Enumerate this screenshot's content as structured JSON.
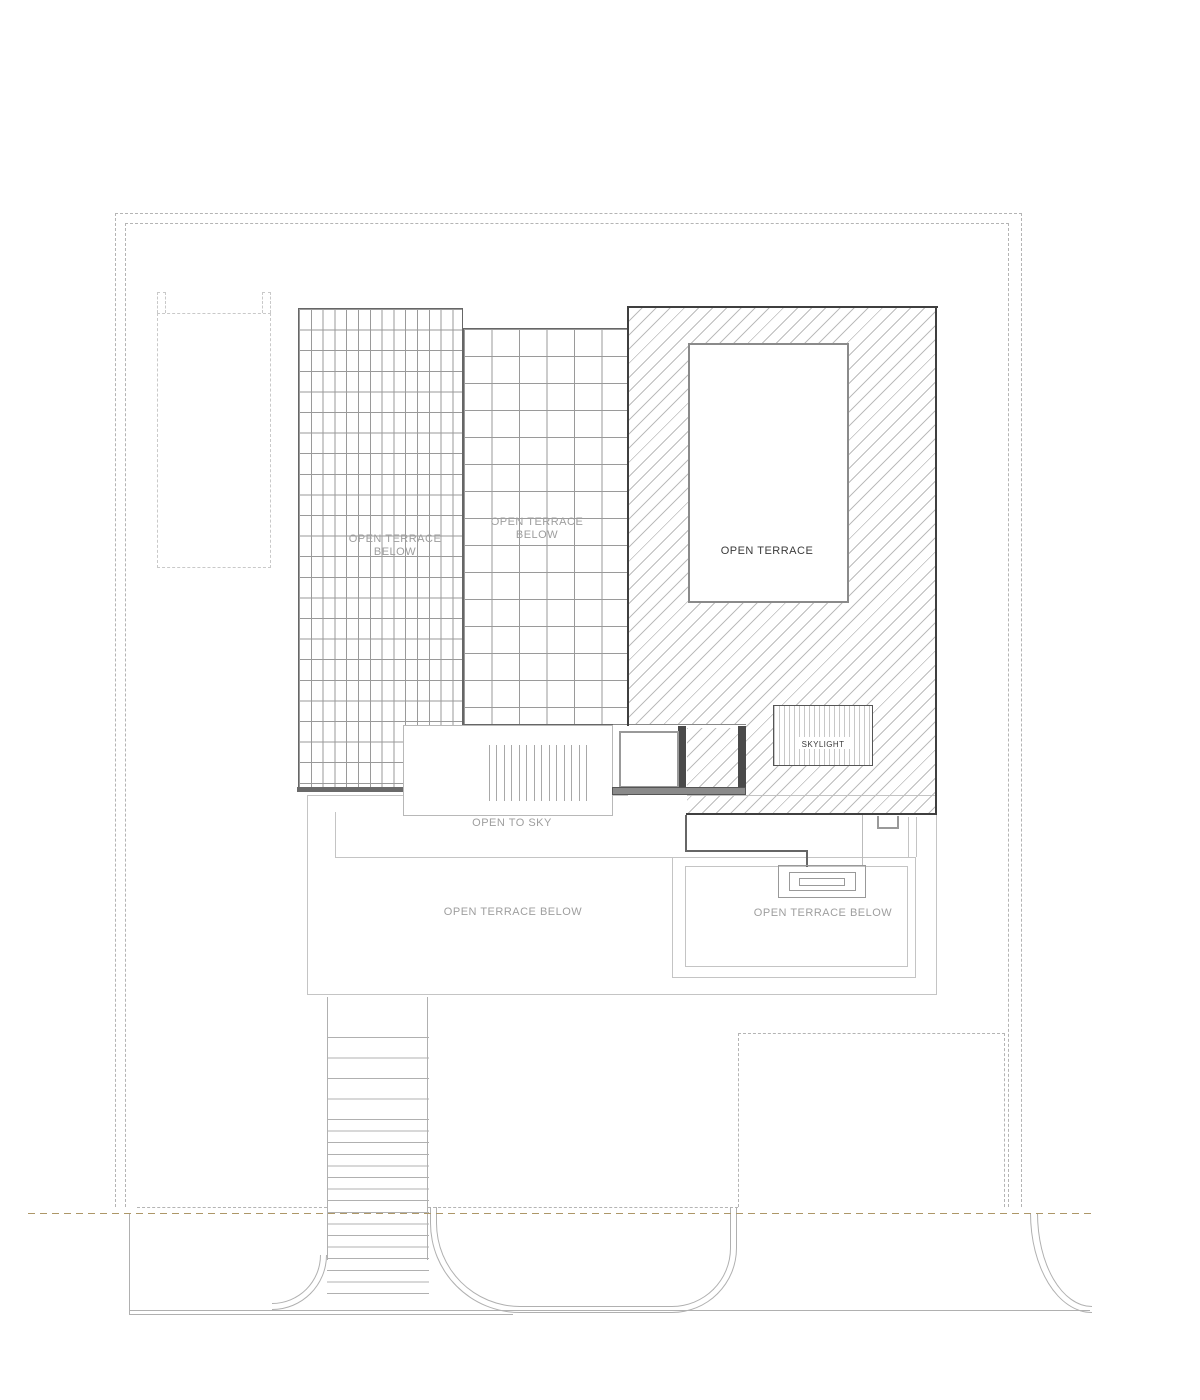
{
  "drawing": {
    "title": "roof-terrace-plan",
    "labels": {
      "terrace_left": "OPEN TERRACE\nBELOW",
      "terrace_mid": "OPEN TERRACE\nBELOW",
      "open_terrace_main": "OPEN TERRACE",
      "skylight": "SKYLIGHT",
      "open_to_sky": "OPEN TO SKY",
      "terrace_below_center": "OPEN TERRACE BELOW",
      "terrace_below_right": "OPEN TERRACE BELOW"
    },
    "colors": {
      "line_dark": "#3f3f3f",
      "line_mid": "#8a8a8a",
      "line_light": "#c4c4c4",
      "boundary_dash": "#b4b4b4",
      "hatch": "#bcbcbc",
      "grid": "#9a9a9a",
      "label_gray": "#9e9e9e",
      "label_dark": "#3a3a3a",
      "setback_dash": "#ad9768",
      "parapet_bar": "#8a8a8a",
      "stair_line": "#b0b0b0",
      "wall": "#4a4a4a",
      "paper": "#ffffff"
    }
  }
}
